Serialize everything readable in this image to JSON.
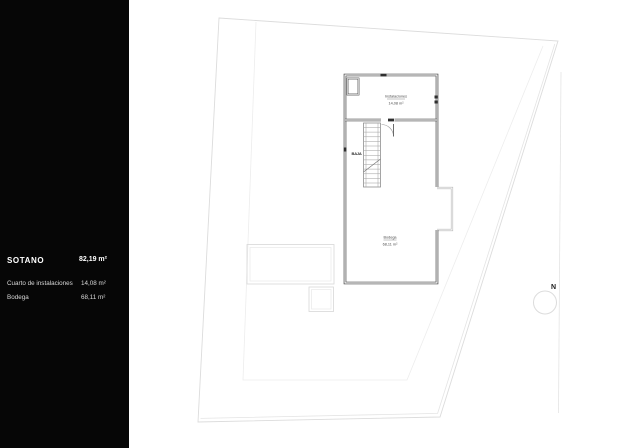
{
  "colors": {
    "sidebar_bg": "#060606",
    "sidebar_text": "#f2f2f2",
    "wall_dark": "#3c3c3c",
    "wall_light": "#b5b5b5",
    "site_line": "#dcdcdc"
  },
  "sidebar": {
    "title": "SOTANO",
    "title_area": "82,19 m²",
    "rows": [
      {
        "label": "Cuarto de instalaciones",
        "area": "14,08 m²"
      },
      {
        "label": "Bodega",
        "area": "68,11 m²"
      }
    ]
  },
  "plan": {
    "rooms": [
      {
        "name": "Instalaciones",
        "area": "14,08 m²"
      },
      {
        "name": "Bodega",
        "area": "68,11 m²"
      }
    ],
    "stair_label": "BAJA",
    "compass_label": "N"
  }
}
